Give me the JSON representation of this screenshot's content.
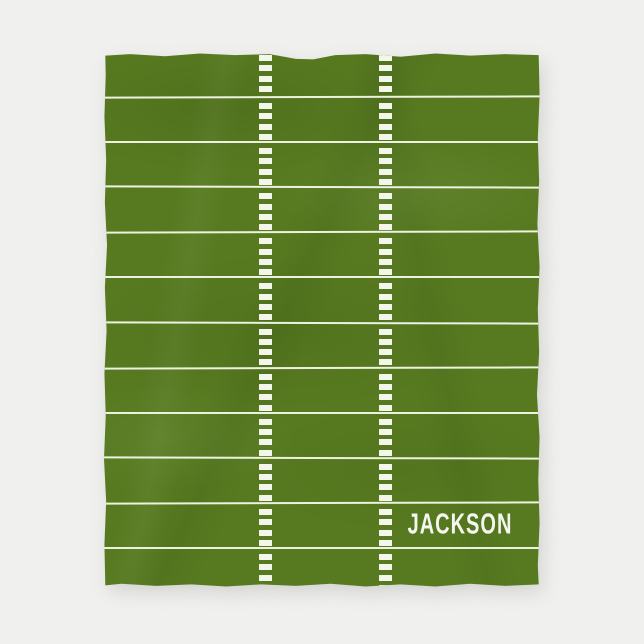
{
  "scene": {
    "background_color": "#f0f0ee"
  },
  "blanket": {
    "name_text": "JACKSON",
    "field_color": "#577a20",
    "yard_line_color": "#edf2de",
    "hash_mark_color": "#f3f6ea",
    "name_text_color": "#f4f6ef",
    "yard_lines_count": 11,
    "strips_count": 12,
    "hashes_per_strip": 4,
    "hash_columns_x": [
      161,
      281
    ]
  }
}
